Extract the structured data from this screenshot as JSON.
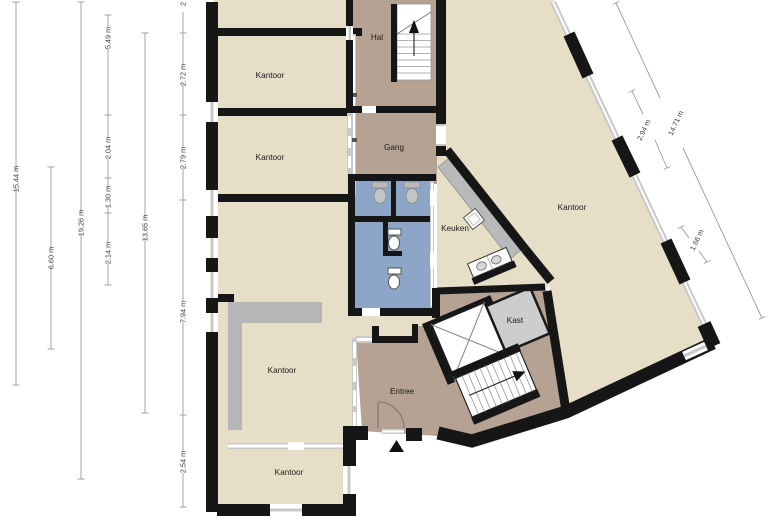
{
  "plan": {
    "room_labels": [
      {
        "id": "kantoor-top-a",
        "text": "Kantoor"
      },
      {
        "id": "kantoor-top-b",
        "text": "Kantoor"
      },
      {
        "id": "kantoor-left",
        "text": "Kantoor"
      },
      {
        "id": "kantoor-bottom",
        "text": "Kantoor"
      },
      {
        "id": "kantoor-right",
        "text": "Kantoor"
      },
      {
        "id": "hal",
        "text": "Hal"
      },
      {
        "id": "gang",
        "text": "Gang"
      },
      {
        "id": "keuken",
        "text": "Keuken"
      },
      {
        "id": "kast",
        "text": "Kast"
      },
      {
        "id": "entree",
        "text": "Entree"
      }
    ],
    "dimensions_left": [
      {
        "text": "15.44 m"
      },
      {
        "text": "6.60 m"
      },
      {
        "text": "19.26 m"
      },
      {
        "text": "5.49 m"
      },
      {
        "text": "2.04 m"
      },
      {
        "text": "1.30 m"
      },
      {
        "text": "2.14 m"
      },
      {
        "text": "13.65 m"
      },
      {
        "text": "2"
      },
      {
        "text": "2.72 m"
      },
      {
        "text": "2.79 m"
      },
      {
        "text": "7.94 m"
      },
      {
        "text": "2.54 m"
      }
    ],
    "dimensions_right": [
      {
        "text": "2.94 m"
      },
      {
        "text": "14.71 m"
      },
      {
        "text": "1.66 m"
      }
    ],
    "colors": {
      "office": "#e6dec6",
      "hall": "#b5a292",
      "wet": "#8da5c6",
      "wall": "#161616",
      "glass": "#c9c9c9",
      "counter": "#b7b9ba",
      "closet": "#cdcdcd",
      "grayzone": "#b4b6b8",
      "dim_line": "#9b9b9b",
      "dim_text": "#3a3a3a",
      "label_text": "#1c1c1c"
    }
  }
}
